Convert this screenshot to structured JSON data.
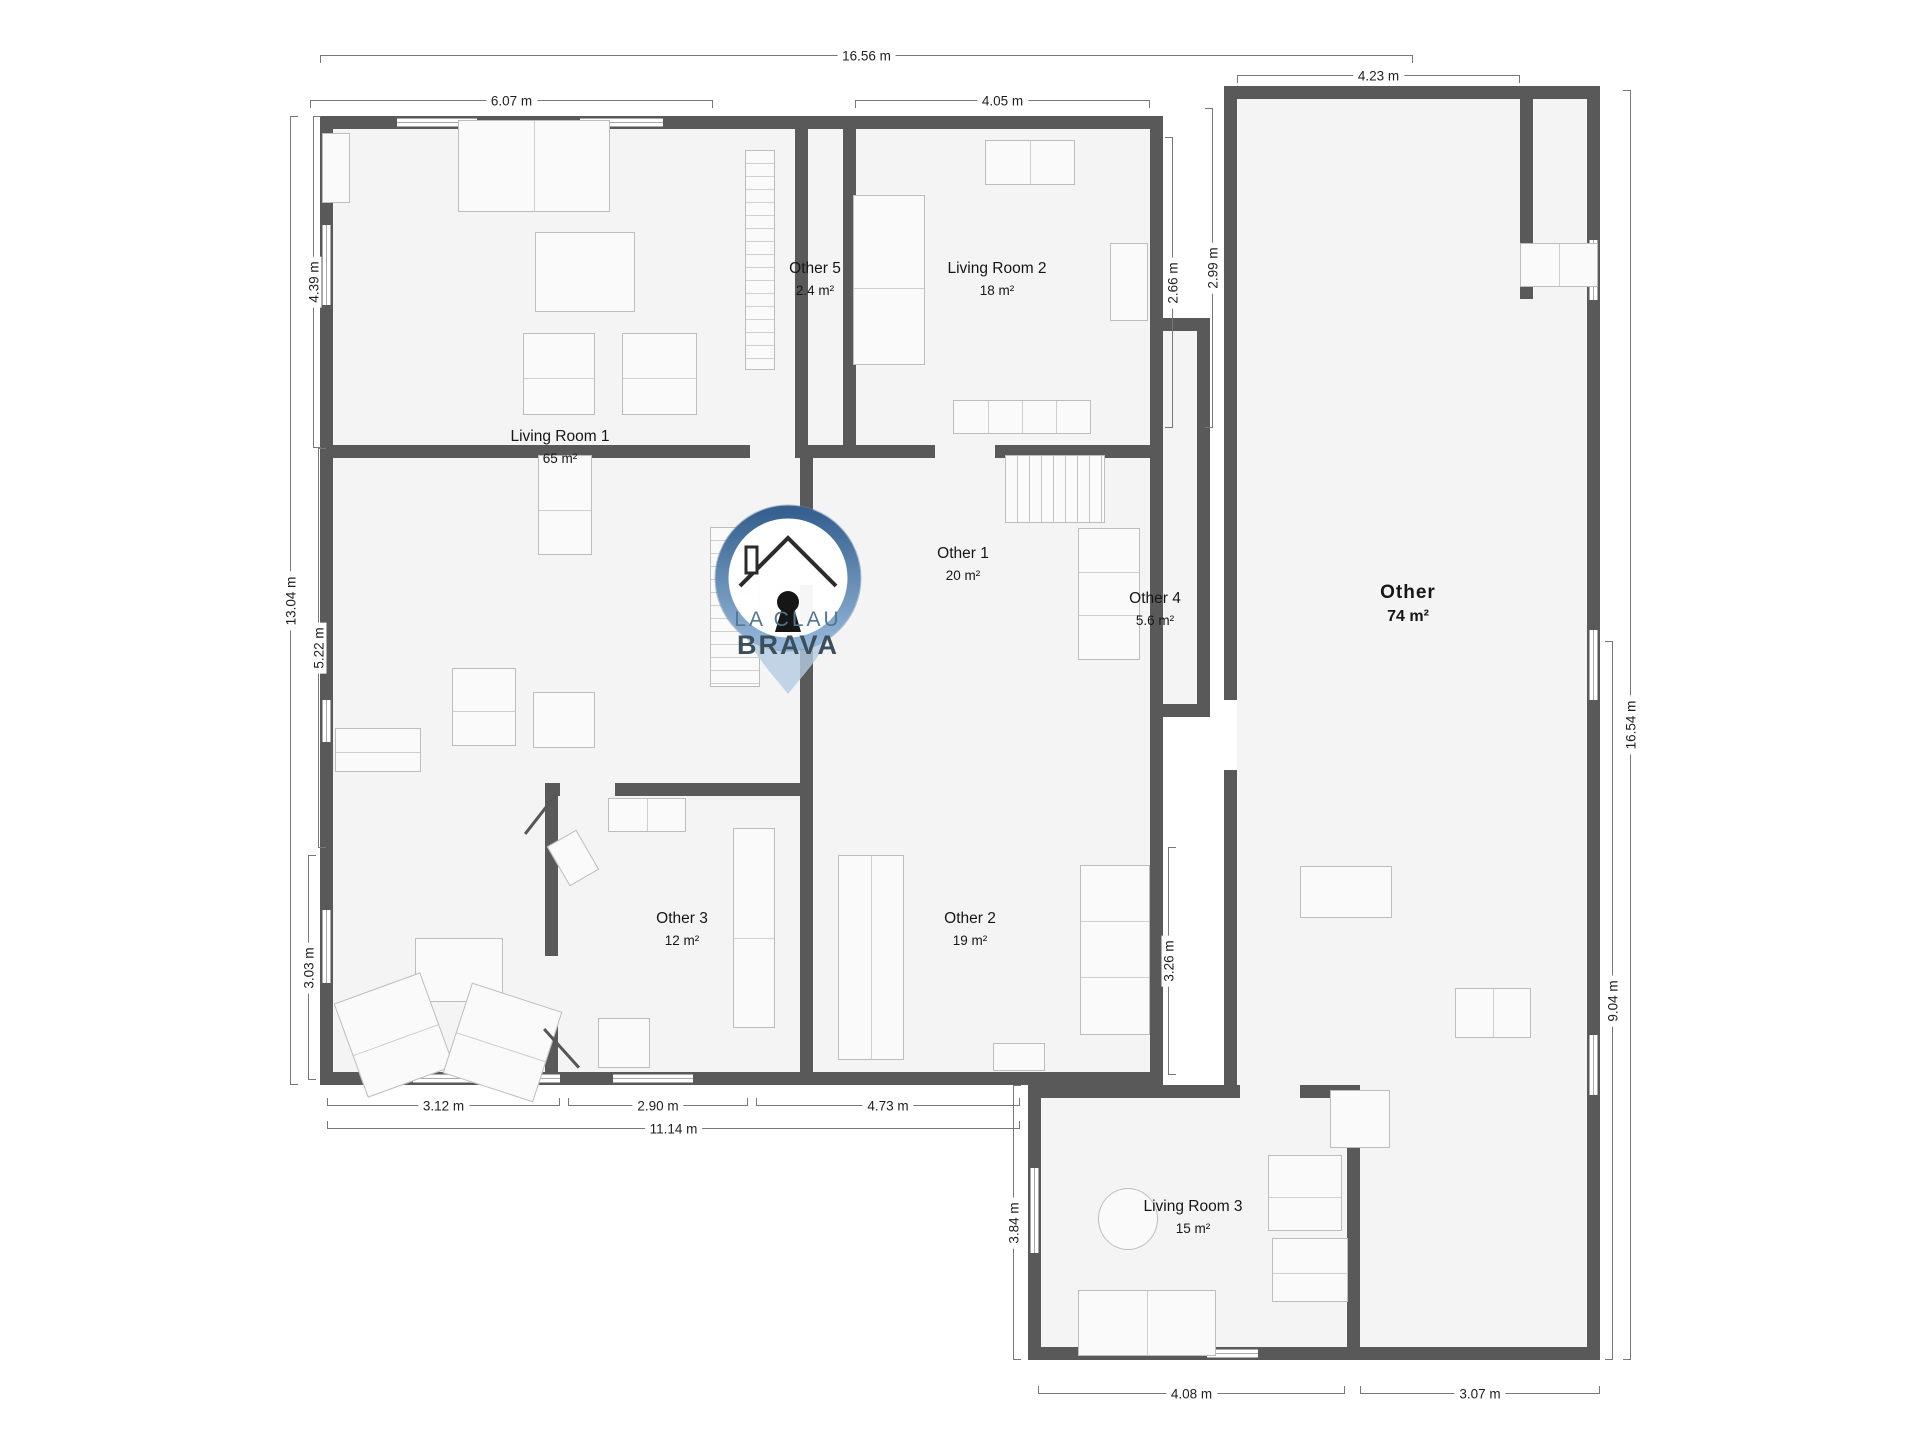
{
  "watermark": {
    "line1": "LA CLAU",
    "line2": "BRAVA"
  },
  "rooms": [
    {
      "name": "Living Room 1",
      "area": "65 m²",
      "cx": 560,
      "cy": 440,
      "big": false
    },
    {
      "name": "Other 5",
      "area": "2.4 m²",
      "cx": 815,
      "cy": 272,
      "big": false
    },
    {
      "name": "Living Room 2",
      "area": "18 m²",
      "cx": 997,
      "cy": 272,
      "big": false
    },
    {
      "name": "Other 1",
      "area": "20 m²",
      "cx": 963,
      "cy": 557,
      "big": false
    },
    {
      "name": "Other 4",
      "area": "5.6 m²",
      "cx": 1155,
      "cy": 602,
      "big": false
    },
    {
      "name": "Other",
      "area": "74 m²",
      "cx": 1408,
      "cy": 596,
      "big": true
    },
    {
      "name": "Other 3",
      "area": "12 m²",
      "cx": 682,
      "cy": 922,
      "big": false
    },
    {
      "name": "Other 2",
      "area": "19 m²",
      "cx": 970,
      "cy": 922,
      "big": false
    },
    {
      "name": "Living Room 3",
      "area": "15 m²",
      "cx": 1193,
      "cy": 1210,
      "big": false
    }
  ],
  "dimensions": [
    {
      "label": "16.56 m",
      "o": "h",
      "x": 320,
      "y": 55,
      "len": 1093,
      "tick": "down"
    },
    {
      "label": "6.07 m",
      "o": "h",
      "x": 310,
      "y": 100,
      "len": 403,
      "tick": "down"
    },
    {
      "label": "4.05 m",
      "o": "h",
      "x": 855,
      "y": 100,
      "len": 295,
      "tick": "down"
    },
    {
      "label": "4.23 m",
      "o": "h",
      "x": 1237,
      "y": 75,
      "len": 283,
      "tick": "down"
    },
    {
      "label": "13.04 m",
      "o": "v",
      "x": 290,
      "y": 116,
      "len": 969,
      "tick": "right"
    },
    {
      "label": "4.39 m",
      "o": "v",
      "x": 313,
      "y": 116,
      "len": 332,
      "tick": "right"
    },
    {
      "label": "5.22 m",
      "o": "v",
      "x": 318,
      "y": 448,
      "len": 400,
      "tick": "right"
    },
    {
      "label": "3.03 m",
      "o": "v",
      "x": 308,
      "y": 855,
      "len": 225,
      "tick": "right"
    },
    {
      "label": "3.12 m",
      "o": "h",
      "x": 327,
      "y": 1105,
      "len": 233,
      "tick": "up"
    },
    {
      "label": "2.90 m",
      "o": "h",
      "x": 568,
      "y": 1105,
      "len": 180,
      "tick": "up"
    },
    {
      "label": "4.73 m",
      "o": "h",
      "x": 756,
      "y": 1105,
      "len": 264,
      "tick": "up"
    },
    {
      "label": "11.14 m",
      "o": "h",
      "x": 327,
      "y": 1128,
      "len": 693,
      "tick": "up"
    },
    {
      "label": "4.08 m",
      "o": "h",
      "x": 1038,
      "y": 1393,
      "len": 307,
      "tick": "up"
    },
    {
      "label": "3.07 m",
      "o": "h",
      "x": 1360,
      "y": 1393,
      "len": 240,
      "tick": "up"
    },
    {
      "label": "3.84 m",
      "o": "v",
      "x": 1013,
      "y": 1085,
      "len": 275,
      "tick": "right"
    },
    {
      "label": "16.54 m",
      "o": "v",
      "x": 1630,
      "y": 90,
      "len": 1270,
      "tick": "left"
    },
    {
      "label": "9.04 m",
      "o": "v",
      "x": 1612,
      "y": 641,
      "len": 719,
      "tick": "left"
    },
    {
      "label": "2.66 m",
      "o": "v",
      "x": 1172,
      "y": 137,
      "len": 291,
      "tick": "left"
    },
    {
      "label": "2.99 m",
      "o": "v",
      "x": 1212,
      "y": 108,
      "len": 320,
      "tick": "left"
    },
    {
      "label": "3.26 m",
      "o": "v",
      "x": 1168,
      "y": 847,
      "len": 228,
      "tick": "right"
    }
  ],
  "colors": {
    "wall": "#595959",
    "room_fill": "#f4f4f4",
    "dim_line": "#787878",
    "furniture_stroke": "#bdbdbd",
    "logo_ring_dark": "#35608f",
    "logo_ring_light": "#93b6d8",
    "logo_tail": "#b3cce2",
    "logo_text_1": "#54758f",
    "logo_text_2": "#3c4d5c"
  }
}
